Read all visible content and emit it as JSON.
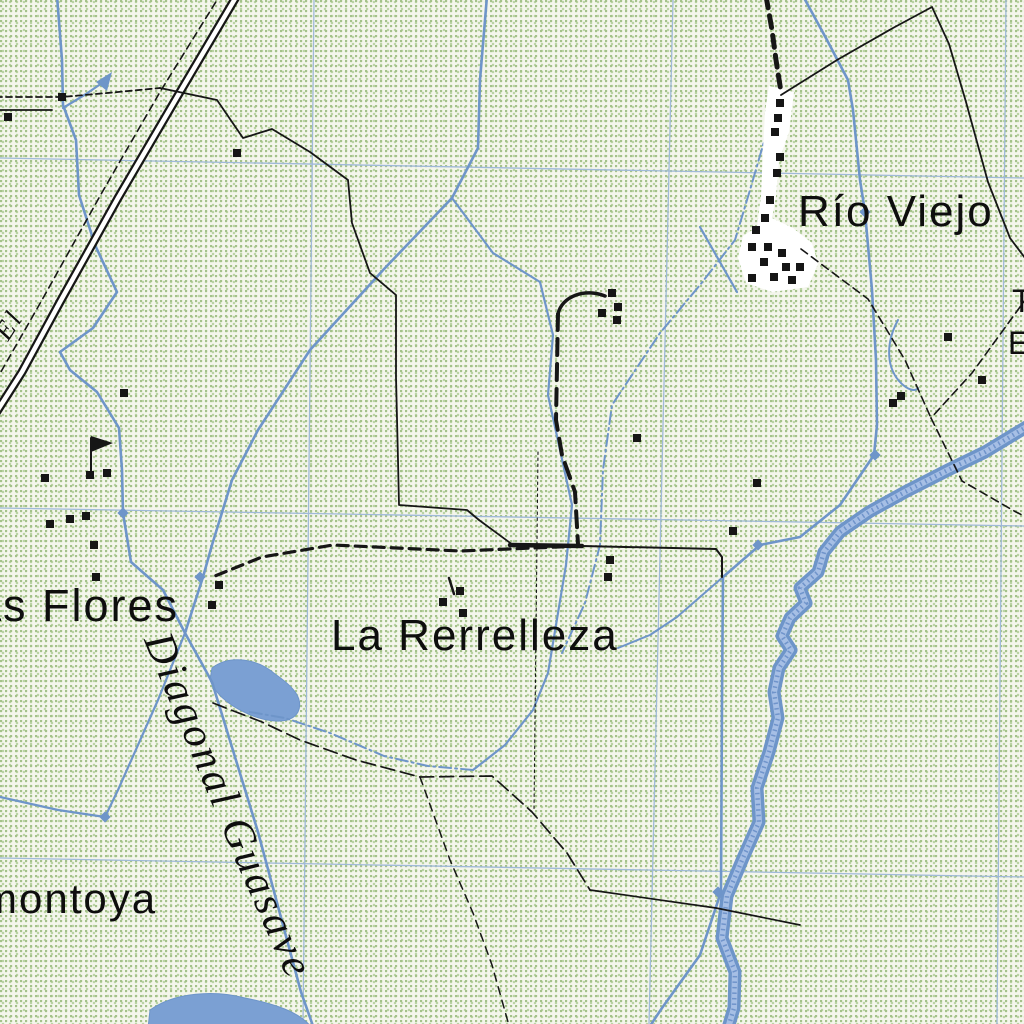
{
  "map": {
    "labels": {
      "rio_viejo": "Río Viejo",
      "la_rerrelleza": "La Rerrelleza",
      "las_flores_partial": "as Flores",
      "montoya_partial": "montoya",
      "diagonal_guasave": "Diagonal Guasave",
      "el_partial": "El",
      "edge_partial_top": "T",
      "edge_partial_bottom": "E"
    },
    "colors": {
      "stipple": "#a3c289",
      "stipple2": "#bad3a4",
      "grid": "#9fb9d9",
      "water": "#6e95c9",
      "waterfill": "#7ba0d3",
      "waterlight": "#a6bfe5",
      "road": "#161616"
    },
    "buildings": [
      [
        8,
        117
      ],
      [
        62,
        97
      ],
      [
        237,
        153
      ],
      [
        124,
        393
      ],
      [
        45,
        478
      ],
      [
        90,
        475
      ],
      [
        107,
        473
      ],
      [
        50,
        524
      ],
      [
        70,
        519
      ],
      [
        86,
        516
      ],
      [
        94,
        545
      ],
      [
        96,
        577
      ],
      [
        219,
        585
      ],
      [
        212,
        605
      ],
      [
        612,
        293
      ],
      [
        618,
        307
      ],
      [
        602,
        313
      ],
      [
        617,
        320
      ],
      [
        637,
        438
      ],
      [
        757,
        483
      ],
      [
        610,
        560
      ],
      [
        608,
        577
      ],
      [
        733,
        531
      ],
      [
        893,
        403
      ],
      [
        901,
        396
      ],
      [
        948,
        337
      ],
      [
        982,
        380
      ],
      [
        780,
        103
      ],
      [
        778,
        118
      ],
      [
        775,
        132
      ],
      [
        780,
        157
      ],
      [
        777,
        173
      ],
      [
        770,
        200
      ],
      [
        765,
        218
      ],
      [
        756,
        230
      ],
      [
        752,
        247
      ],
      [
        768,
        247
      ],
      [
        782,
        253
      ],
      [
        764,
        262
      ],
      [
        786,
        267
      ],
      [
        800,
        267
      ],
      [
        752,
        278
      ],
      [
        774,
        277
      ],
      [
        792,
        280
      ],
      [
        443,
        602
      ],
      [
        460,
        591
      ],
      [
        463,
        613
      ]
    ],
    "flow_nodes": [
      [
        865,
        212
      ],
      [
        875,
        455
      ],
      [
        758,
        545
      ],
      [
        718,
        892
      ],
      [
        105,
        817
      ],
      [
        123,
        513
      ],
      [
        200,
        577
      ]
    ]
  }
}
